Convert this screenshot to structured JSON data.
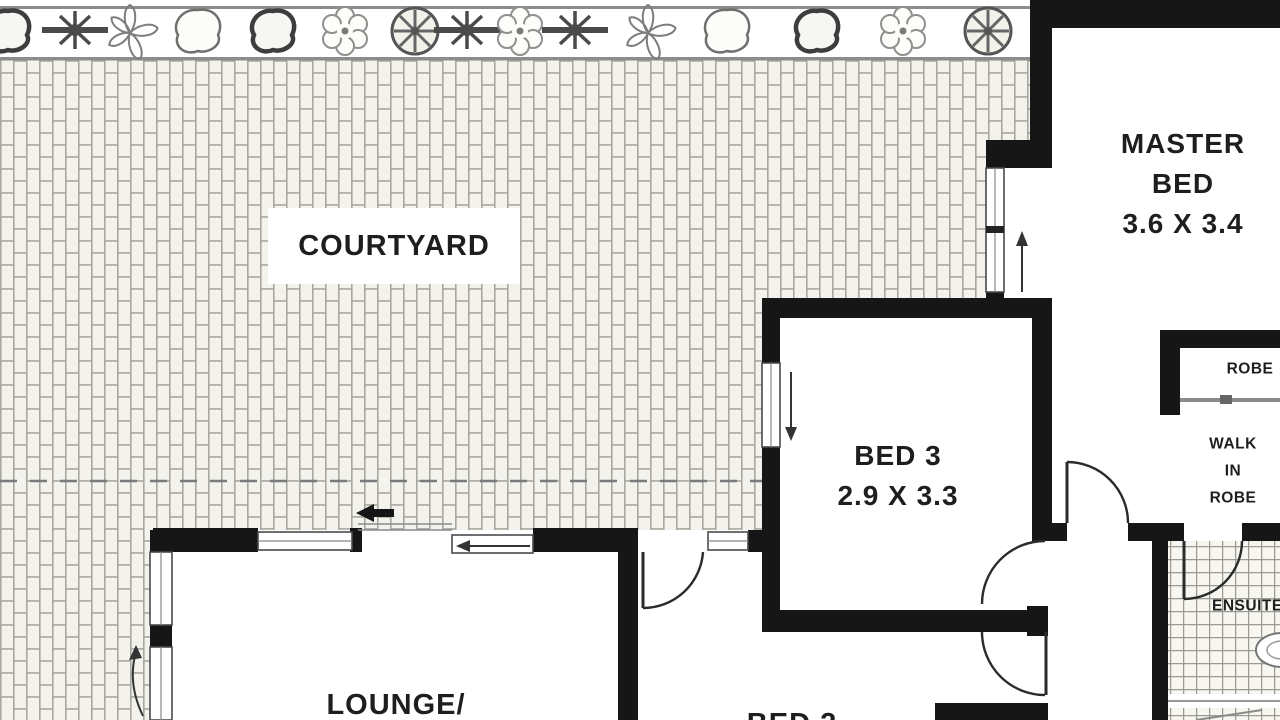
{
  "rooms": {
    "courtyard": {
      "label": "COURTYARD"
    },
    "master_bed": {
      "name_line1": "MASTER",
      "name_line2": "BED",
      "dimensions": "3.6 X 3.4"
    },
    "bed_3": {
      "name": "BED 3",
      "dimensions": "2.9 X 3.3"
    },
    "robe": {
      "name": "ROBE"
    },
    "walk_in_robe": {
      "line1": "WALK",
      "line2": "IN",
      "line3": "ROBE"
    },
    "ensuite": {
      "name": "ENSUITE"
    },
    "lounge": {
      "name": "LOUNGE/"
    },
    "bed_2": {
      "name": "BED 2"
    }
  },
  "colors": {
    "wall": "#161616",
    "door_line": "#2b2b2b",
    "brick_bg": "#f3f2ec",
    "mortar": "#a9a8a0",
    "tile_bg": "#f7f6f0",
    "tile_line": "#9b9b93",
    "garden_line": "#8c8c8c",
    "plant": "#6f6f6f",
    "dashed": "#7a7a7a",
    "rail": "#8a8a8a",
    "window_frame": "#4a4a4a",
    "arrow": "#333333"
  }
}
